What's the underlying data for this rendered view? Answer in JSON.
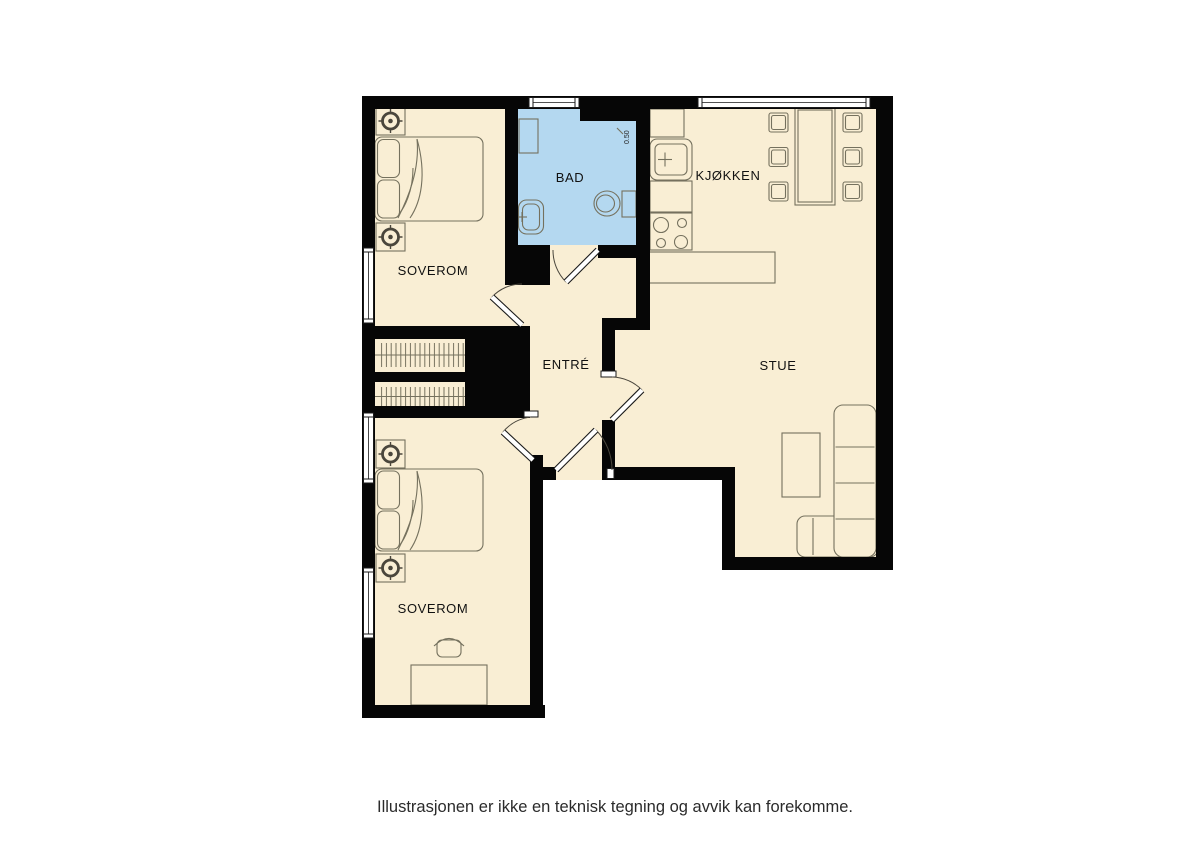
{
  "caption": {
    "text": "Illustrasjonen er ikke en teknisk tegning og avvik kan forekomme."
  },
  "rooms": [
    {
      "id": "soverom-top",
      "label": "SOVEROM"
    },
    {
      "id": "bad",
      "label": "BAD"
    },
    {
      "id": "kjokken",
      "label": "KJØKKEN"
    },
    {
      "id": "entre",
      "label": "ENTRÉ"
    },
    {
      "id": "stue",
      "label": "STUE"
    },
    {
      "id": "soverom-bottom",
      "label": "SOVEROM"
    }
  ],
  "annotations": {
    "bath_dimension": "0.50"
  },
  "palette": {
    "room_fill": "#f9eed4",
    "bath_fill": "#b4d8f0",
    "wall": "#060606",
    "furniture_outline": "#75715e",
    "label_color": "#111111",
    "caption_color": "#2b2b2b"
  }
}
